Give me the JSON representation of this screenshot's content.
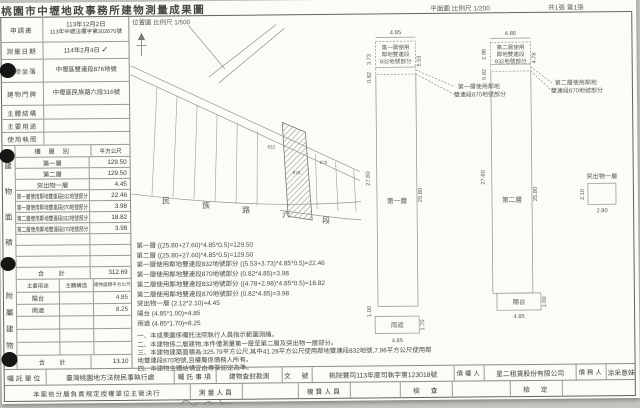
{
  "header": {
    "title": "桃園市中壢地政事務所建物測量成果圖",
    "location_scale": "位置圖 比例尺 1/500",
    "plan_scale": "平面圖 比例尺 1/200",
    "sheet": "共1張 第1張"
  },
  "icons": {
    "check": "✓",
    "north_arrow": "↑"
  },
  "info": {
    "rows": [
      {
        "label": "申請書",
        "value": "113年12月2日",
        "value2": "113年中壢法囑字第302670號"
      },
      {
        "label": "測量日期",
        "value": "114年2月4日"
      },
      {
        "label": "建物坐落",
        "value": "中壢區雙連段876地號"
      },
      {
        "label": "建物門牌",
        "value": "中壢區民族路六段316號"
      },
      {
        "label": "主體結構",
        "value": ""
      },
      {
        "label": "主要用途",
        "value": ""
      },
      {
        "label": "使用執照",
        "value": ""
      }
    ]
  },
  "area_table": {
    "side_label": "建物面積",
    "floor_header": "樓 層 別",
    "unit_header": "平方公尺",
    "rows": [
      {
        "floor": "第一層",
        "area": "129.50"
      },
      {
        "floor": "第二層",
        "area": "129.50"
      },
      {
        "floor": "突出物一層",
        "area": "4.45"
      },
      {
        "floor": "第一層使用鄰地雙連段832地號部分",
        "area": "22.46"
      },
      {
        "floor": "第一層使用鄰地雙連段870地號部分",
        "area": "3.98"
      },
      {
        "floor": "第二層使用鄰地雙連段832地號部分",
        "area": "18.82"
      },
      {
        "floor": "第二層使用鄰地雙連段870地號部分",
        "area": "3.98"
      }
    ],
    "total_label": "合　計",
    "total": "312.69"
  },
  "annex_table": {
    "side_label": "附屬建物",
    "headers": [
      "主要用途",
      "主體構造",
      "建物面積平方公尺"
    ],
    "rows": [
      {
        "use": "陽台",
        "area": "4.85"
      },
      {
        "use": "雨遮",
        "area": "8.25"
      }
    ],
    "total_label": "合　計",
    "total": "13.10"
  },
  "site_map": {
    "road_name": [
      "民",
      "族",
      "路",
      "六",
      "段"
    ],
    "parcels": [
      "832",
      "876",
      "870"
    ]
  },
  "calculations": [
    "第一層 ((25.80+27.60)*4.85*0.5)=129.50",
    "第二層 ((25.80+27.60)*4.85*0.5)=129.50",
    "第一層使用鄰地雙連段832地號部分 ((5.53+3.73)*4.85*0.5)=22.46",
    "第一層使用鄰地雙連段870地號部分 (0.82*4.85)=3.98",
    "第二層使用鄰地雙連段832地號部分 ((4.78+2.98)*4.85*0.5)=18.82",
    "第二層使用鄰地雙連段870地號部分 (0.82*4.85)=3.98",
    "突出物一層 (2.12*2.10)=4.45",
    "陽台 (4.85*1.00)=4.85",
    "雨遮 (4.85*1.70)=8.25"
  ],
  "notes": [
    "一、本成果圖係囑託法院執行人員指示範圍測繪。",
    "二、本建物係二層建物,本件僅測量第一層至第二層及突出物一層部分。",
    "三、本建物建築面積為:325.79平方公尺,其中41.28平方公尺使用鄰地雙連段832地號,7.96平方公尺使用鄰地雙連段870地號,且權屬係債務人所有。",
    "四、本建物主體結構宜由專業認定為準。"
  ],
  "plans": {
    "a": {
      "box_label": [
        "第一層使用",
        "鄰地雙連段",
        "832地號部分"
      ],
      "callout": [
        "第一層使用鄰地",
        "雙連段870地號部分"
      ],
      "strip_label": "第一層",
      "canopy_label": "雨遮",
      "dims": {
        "top": "4.85",
        "left_upper": "3.73",
        "left_lower": "0.82",
        "right_upper": "5.53",
        "strip_left": "27.60",
        "strip_right": "25.80",
        "step": "1.00",
        "canopy_depth": "1.70",
        "canopy_width": "4.85"
      }
    },
    "b": {
      "box_label": [
        "第二層使用",
        "鄰地雙連段",
        "832地號部分"
      ],
      "callout": [
        "第二層使用鄰地",
        "雙連段870地號部分"
      ],
      "strip_label": "第二層",
      "balcony_label": "陽台",
      "dims": {
        "top": "4.85",
        "left_upper": "2.98",
        "left_lower": "0.82",
        "right_upper": "4.78",
        "strip_left": "27.60",
        "strip_right": "25.80",
        "balcony_depth": "1.00",
        "balcony_width": "4.85"
      }
    },
    "c": {
      "label": "突出物一層",
      "dims": {
        "left": "2.10",
        "bottom": "2.80"
      }
    }
  },
  "footer": {
    "row1": [
      {
        "label": "囑託單位",
        "value": "臺灣桃園地方法院民事執行處"
      },
      {
        "label": "囑託事項",
        "value": "建物查封勘測"
      },
      {
        "label": "文　號",
        "value": "桃院豐司113年度司執字第123018號"
      },
      {
        "label": "債權人",
        "value": "星二租賃股份有限公司"
      },
      {
        "label": "債務人",
        "value": "涂采意妹"
      }
    ],
    "row2": {
      "delegation": "本案依分層負責規定授權單位主管決行",
      "surveyor_label": "測量人員",
      "reviewer_label": "複算人員",
      "check_label": "檢　查",
      "verify_label": "檢　定"
    }
  }
}
